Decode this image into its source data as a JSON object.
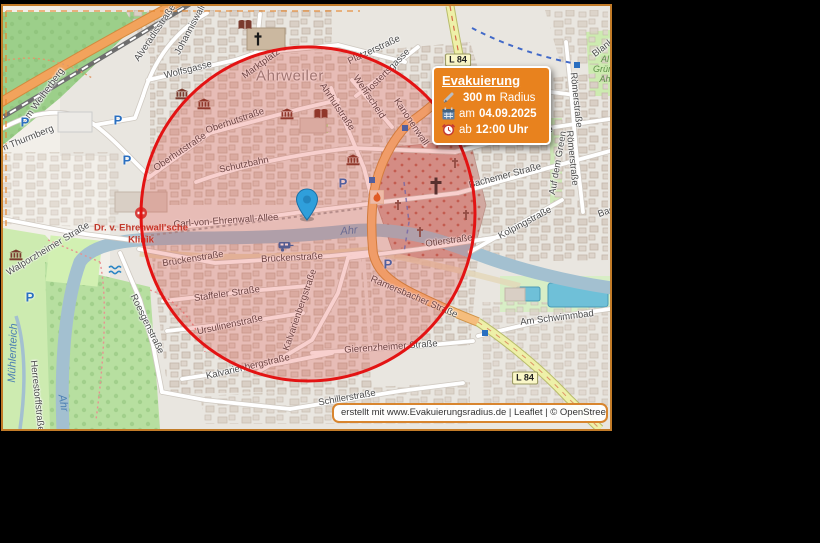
{
  "map": {
    "frame_border_color": "#c27b28",
    "parking_glyph": "P",
    "overlay_circle": {
      "cx": 308,
      "cy": 214,
      "r": 167,
      "stroke": "#e31313",
      "fill": "rgba(221,40,30,0.22)"
    },
    "marker_color": "#2f9fdb",
    "labels": [
      {
        "text": "Alveradisstraße",
        "x": 155,
        "y": 33,
        "r": -56
      },
      {
        "text": "Johanniswall",
        "x": 190,
        "y": 30,
        "r": -62
      },
      {
        "text": "Wolfsgasse",
        "x": 188,
        "y": 70,
        "r": -14
      },
      {
        "text": "Am Weiherberg",
        "x": 43,
        "y": 96,
        "r": -54
      },
      {
        "text": "Am Thurmberg",
        "x": 24,
        "y": 140,
        "r": -22
      },
      {
        "text": "Marktplatz",
        "x": 261,
        "y": 64,
        "r": -36
      },
      {
        "text": "Plätzerstraße",
        "x": 374,
        "y": 50,
        "r": -25
      },
      {
        "text": "Hostertsgasse",
        "x": 387,
        "y": 72,
        "r": -45
      },
      {
        "text": "Wehrscheid",
        "x": 369,
        "y": 97,
        "r": 56
      },
      {
        "text": "Kanonenwall",
        "x": 411,
        "y": 122,
        "r": 56
      },
      {
        "text": "Ahrhutstraße",
        "x": 337,
        "y": 107,
        "r": 56
      },
      {
        "text": "Oberhutstraße",
        "x": 180,
        "y": 152,
        "r": -34
      },
      {
        "text": "Oberhutstraße",
        "x": 235,
        "y": 121,
        "r": -19
      },
      {
        "text": "Schutzbahn",
        "x": 244,
        "y": 165,
        "r": -12
      },
      {
        "text": "Schutzenstraße",
        "x": 520,
        "y": 135,
        "r": -10
      },
      {
        "text": "Bachemer Straße",
        "x": 505,
        "y": 176,
        "r": -15
      },
      {
        "text": "Kolpingstraße",
        "x": 525,
        "y": 223,
        "r": -28
      },
      {
        "text": "Auf dem Green",
        "x": 558,
        "y": 163,
        "r": -80
      },
      {
        "text": "Römerstraße",
        "x": 576,
        "y": 100,
        "r": 84
      },
      {
        "text": "Römerstraße",
        "x": 572,
        "y": 158,
        "r": 84
      },
      {
        "text": "Otlerstraße",
        "x": 449,
        "y": 241,
        "r": -8
      },
      {
        "text": "Carl-von-Ehrenwall-Allee",
        "x": 226,
        "y": 221,
        "r": -4
      },
      {
        "text": "Brückenstraße",
        "x": 193,
        "y": 259,
        "r": -9
      },
      {
        "text": "Brückenstraße",
        "x": 292,
        "y": 258,
        "r": -3
      },
      {
        "text": "Walporzheimer Straße",
        "x": 48,
        "y": 249,
        "r": -31
      },
      {
        "text": "Roesgenstraße",
        "x": 147,
        "y": 324,
        "r": 64
      },
      {
        "text": "Staffeler Straße",
        "x": 227,
        "y": 294,
        "r": -8
      },
      {
        "text": "Ursulinenstraße",
        "x": 230,
        "y": 325,
        "r": -12
      },
      {
        "text": "Kalvarienbergstraße",
        "x": 300,
        "y": 310,
        "r": -71
      },
      {
        "text": "Kalvarienbergstraße",
        "x": 248,
        "y": 367,
        "r": -13
      },
      {
        "text": "Gierenzheimer Straße",
        "x": 391,
        "y": 347,
        "r": -4
      },
      {
        "text": "Ramersbacher Straße",
        "x": 414,
        "y": 297,
        "r": 23
      },
      {
        "text": "Schillerstraße",
        "x": 347,
        "y": 398,
        "r": -10
      },
      {
        "text": "Am Schwimmbad",
        "x": 557,
        "y": 318,
        "r": -7
      },
      {
        "text": "Herrestorffstraße",
        "x": 37,
        "y": 396,
        "r": 84
      },
      {
        "text": "Blank",
        "x": 603,
        "y": 48,
        "r": -38
      },
      {
        "text": "Bac",
        "x": 606,
        "y": 212,
        "r": -20
      },
      {
        "text": "Ahrweiler",
        "x": 290,
        "y": 76,
        "r": 0,
        "cls": "town"
      },
      {
        "text": "Ahr",
        "x": 349,
        "y": 231,
        "r": -6,
        "cls": "water"
      },
      {
        "text": "Ahr",
        "x": 63,
        "y": 403,
        "r": 80,
        "cls": "water"
      },
      {
        "text": "Mühlenteich",
        "x": 13,
        "y": 353,
        "r": -88,
        "cls": "water"
      },
      {
        "text": "Dr. v. Ehrenwall'sche",
        "x": 141,
        "y": 228,
        "r": 0,
        "cls": "clinic"
      },
      {
        "text": "Klinik",
        "x": 141,
        "y": 240,
        "r": 0,
        "cls": "clinic"
      },
      {
        "text": "Al",
        "x": 605,
        "y": 59,
        "r": 0,
        "cls": "green"
      },
      {
        "text": "Grün",
        "x": 603,
        "y": 69,
        "r": 0,
        "cls": "green"
      },
      {
        "text": "Ah",
        "x": 605,
        "y": 79,
        "r": 0,
        "cls": "green"
      }
    ],
    "shields": [
      {
        "text": "L 84",
        "x": 458,
        "y": 60
      },
      {
        "text": "L 84",
        "x": 525,
        "y": 378
      }
    ],
    "icons": [
      {
        "type": "museum",
        "x": 182,
        "y": 94
      },
      {
        "type": "museum",
        "x": 204,
        "y": 104
      },
      {
        "type": "museum",
        "x": 287,
        "y": 114
      },
      {
        "type": "museum",
        "x": 353,
        "y": 160
      },
      {
        "type": "museum",
        "x": 16,
        "y": 255
      },
      {
        "type": "book",
        "x": 245,
        "y": 25
      },
      {
        "type": "book",
        "x": 321,
        "y": 114
      },
      {
        "type": "church",
        "x": 258,
        "y": 39
      },
      {
        "type": "crossbig",
        "x": 436,
        "y": 186
      },
      {
        "type": "cross",
        "x": 398,
        "y": 205
      },
      {
        "type": "cross",
        "x": 420,
        "y": 232
      },
      {
        "type": "cross",
        "x": 455,
        "y": 163
      },
      {
        "type": "cross",
        "x": 466,
        "y": 215
      },
      {
        "type": "hospital",
        "x": 141,
        "y": 213
      },
      {
        "type": "flame",
        "x": 377,
        "y": 197
      },
      {
        "type": "caravan",
        "x": 286,
        "y": 247
      },
      {
        "type": "weir",
        "x": 115,
        "y": 270
      },
      {
        "type": "parking",
        "x": 118,
        "y": 120
      },
      {
        "type": "parking",
        "x": 127,
        "y": 160
      },
      {
        "type": "parking",
        "x": 25,
        "y": 122
      },
      {
        "type": "parking",
        "x": 343,
        "y": 183
      },
      {
        "type": "parking",
        "x": 388,
        "y": 264
      },
      {
        "type": "parking",
        "x": 30,
        "y": 297
      },
      {
        "type": "busstop",
        "x": 577,
        "y": 65
      },
      {
        "type": "busstop",
        "x": 485,
        "y": 333
      },
      {
        "type": "busstop",
        "x": 405,
        "y": 128
      },
      {
        "type": "busstop",
        "x": 372,
        "y": 180
      }
    ]
  },
  "evacuation_box": {
    "title": "Evakuierung",
    "background": "#e8821e",
    "rows": [
      {
        "icon": "pencil-icon",
        "prefix": "",
        "bold": "300 m",
        "suffix": " Radius"
      },
      {
        "icon": "calendar-icon",
        "prefix": "am ",
        "bold": "04.09.2025",
        "suffix": ""
      },
      {
        "icon": "clock-icon",
        "prefix": "ab ",
        "bold": "12:00 Uhr",
        "suffix": ""
      }
    ]
  },
  "attribution": {
    "text": "erstellt mit www.Evakuierungsradius.de | Leaflet | © OpenStreetMap contribut..."
  }
}
